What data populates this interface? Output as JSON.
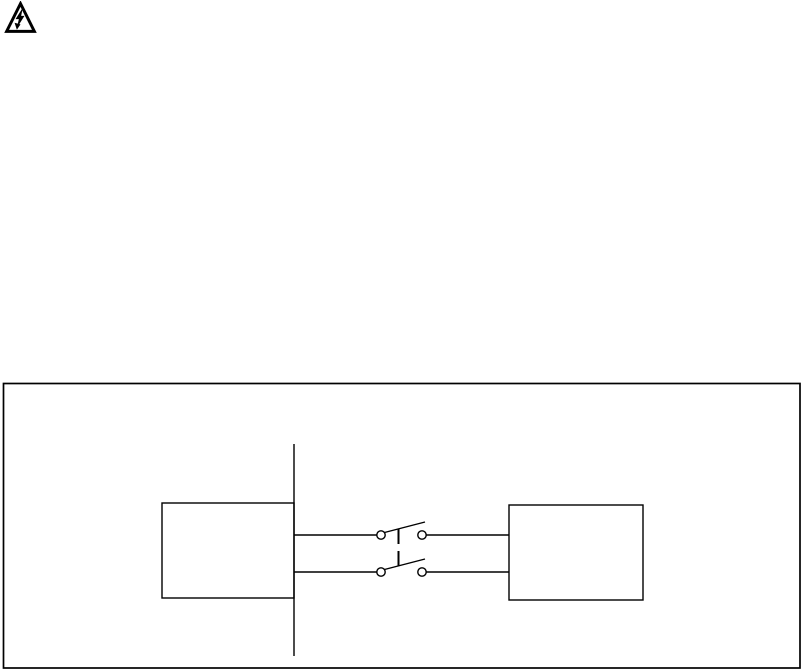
{
  "page": {
    "background_color": "#ffffff",
    "ink_color": "#000000",
    "text_content": ""
  },
  "warning_icon": {
    "name": "high-voltage-warning",
    "glyph": "triangle-with-lightning-bolt"
  },
  "figure": {
    "kind": "wiring-diagram",
    "caption": "",
    "components": {
      "supply_line": "vertical-supply-line",
      "left_box": "unlabeled-device-box",
      "switch": "double-pole-switch-with-linked-blades",
      "right_box": "unlabeled-device-box"
    }
  }
}
